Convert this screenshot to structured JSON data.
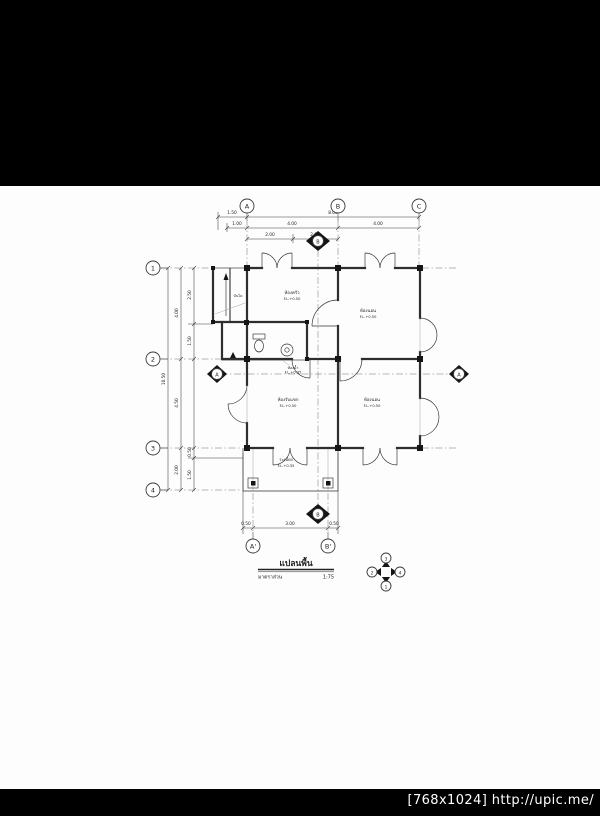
{
  "watermark": "[768x1024] http://upic.me/",
  "colors": {
    "background": "#000000",
    "paper": "#fdfdfd",
    "line": "#2e2e2e"
  },
  "plan": {
    "grid": {
      "cols": [
        "A",
        "B",
        "C"
      ],
      "rows": [
        "1",
        "2",
        "3",
        "4"
      ],
      "cols_bottom": [
        "A'",
        "B'"
      ]
    },
    "sections": {
      "a": "A",
      "b": "B"
    },
    "dims": {
      "top1": [
        "1.50",
        "8.00"
      ],
      "top2": [
        "1.00",
        "4.00",
        "4.00"
      ],
      "top3": [
        "2.00",
        "2.00"
      ],
      "left1": "10.50",
      "left2": [
        "4.00",
        "4.50",
        "2.00"
      ],
      "left3": [
        "2.50",
        "1.50",
        "0.50",
        "1.50"
      ],
      "bottom": [
        "0.50",
        "3.00",
        "0.50"
      ]
    },
    "rooms": {
      "kitchen": {
        "name": "ห้องครัว",
        "level": "F.L.+0.50"
      },
      "bedroom_ne": {
        "name": "ห้องนอน",
        "level": "F.L.+0.50"
      },
      "living": {
        "name": "ห้องรับแขก",
        "level": "F.L.+0.50"
      },
      "bedroom_se": {
        "name": "ห้องนอน",
        "level": "F.L.+0.50"
      },
      "bath": {
        "name": "ห้องน้ำ",
        "level": "F.L.+0.35"
      },
      "porch": {
        "name": "ระเบียง",
        "level": "F.L.+0.35"
      },
      "stair": {
        "name": "บันได"
      }
    },
    "title": {
      "text": "แปลนพื้น",
      "scale_label": "มาตราส่วน",
      "scale_value": "1:75"
    },
    "compass": {
      "top": "3",
      "left": "2",
      "right": "4",
      "bottom": "1"
    }
  }
}
